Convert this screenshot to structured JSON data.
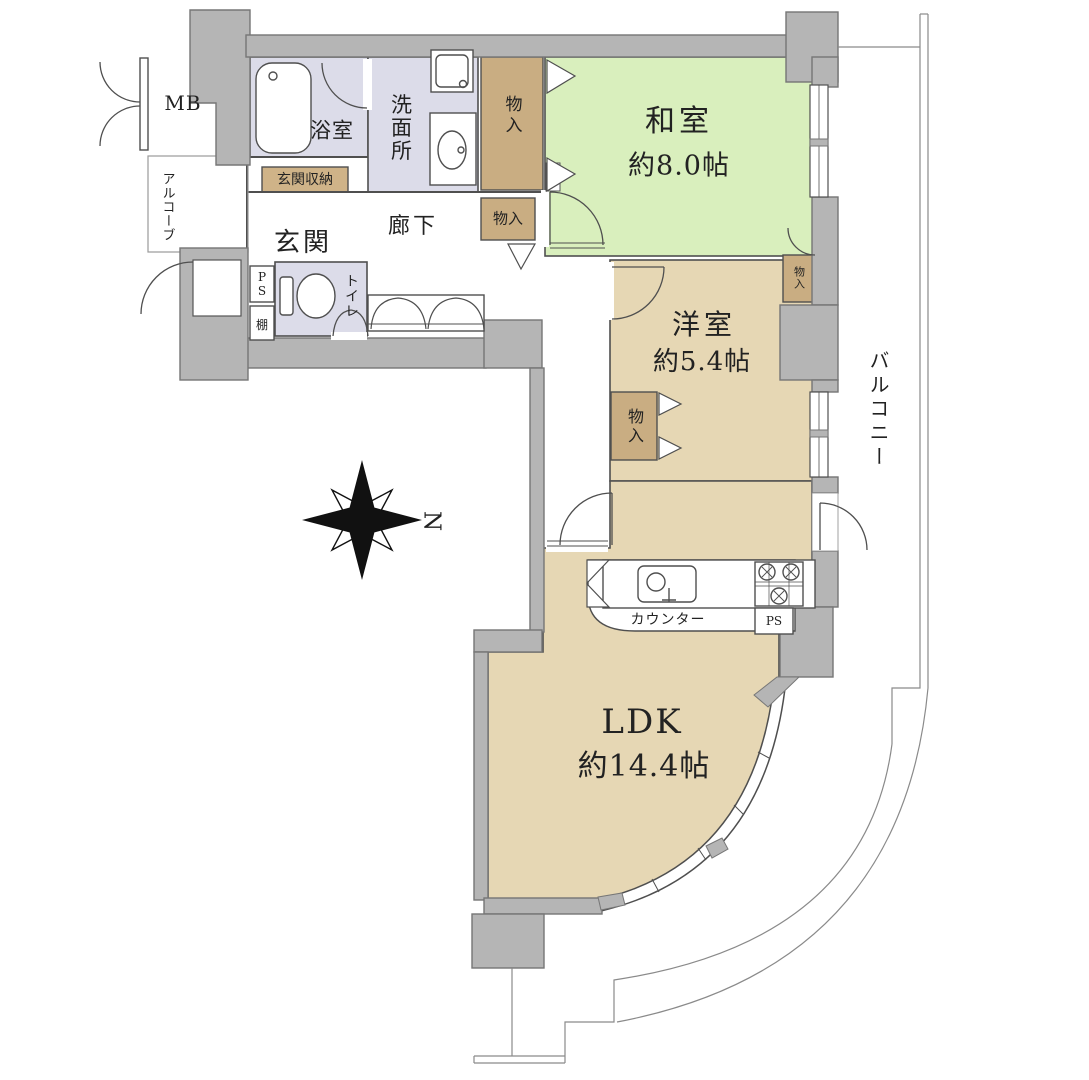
{
  "colors": {
    "wall": "#b5b5b5",
    "wall_outline": "#767676",
    "tatami_green": "#d9efbd",
    "flooring_tan": "#e6d7b4",
    "closet_tan": "#c9ad82",
    "wet_area_lavender": "#dcdce9",
    "line": "#4f4f4f"
  },
  "compass": {
    "north_label": "N"
  },
  "rooms": {
    "washitsu": {
      "name": "和室",
      "size": "約8.0帖"
    },
    "yoshitsu": {
      "name": "洋室",
      "size": "約5.4帖"
    },
    "ldk": {
      "name": "LDK",
      "size": "約14.4帖"
    },
    "genkan": {
      "name": "玄関"
    },
    "rouka": {
      "name": "廊下"
    },
    "yokushitsu": {
      "name": "浴室"
    },
    "senmenjo": {
      "name": "洗面所"
    },
    "toilet": {
      "name": "トイレ"
    },
    "balcony": {
      "name": "バルコニー"
    },
    "alcove": {
      "name": "アルコーブ"
    },
    "meter_box": {
      "name": "MB"
    }
  },
  "storage": {
    "monoire": "物入",
    "genkan_storage": "玄関収納",
    "shelf": "棚",
    "pipe_space": "PS",
    "counter": "カウンター"
  }
}
